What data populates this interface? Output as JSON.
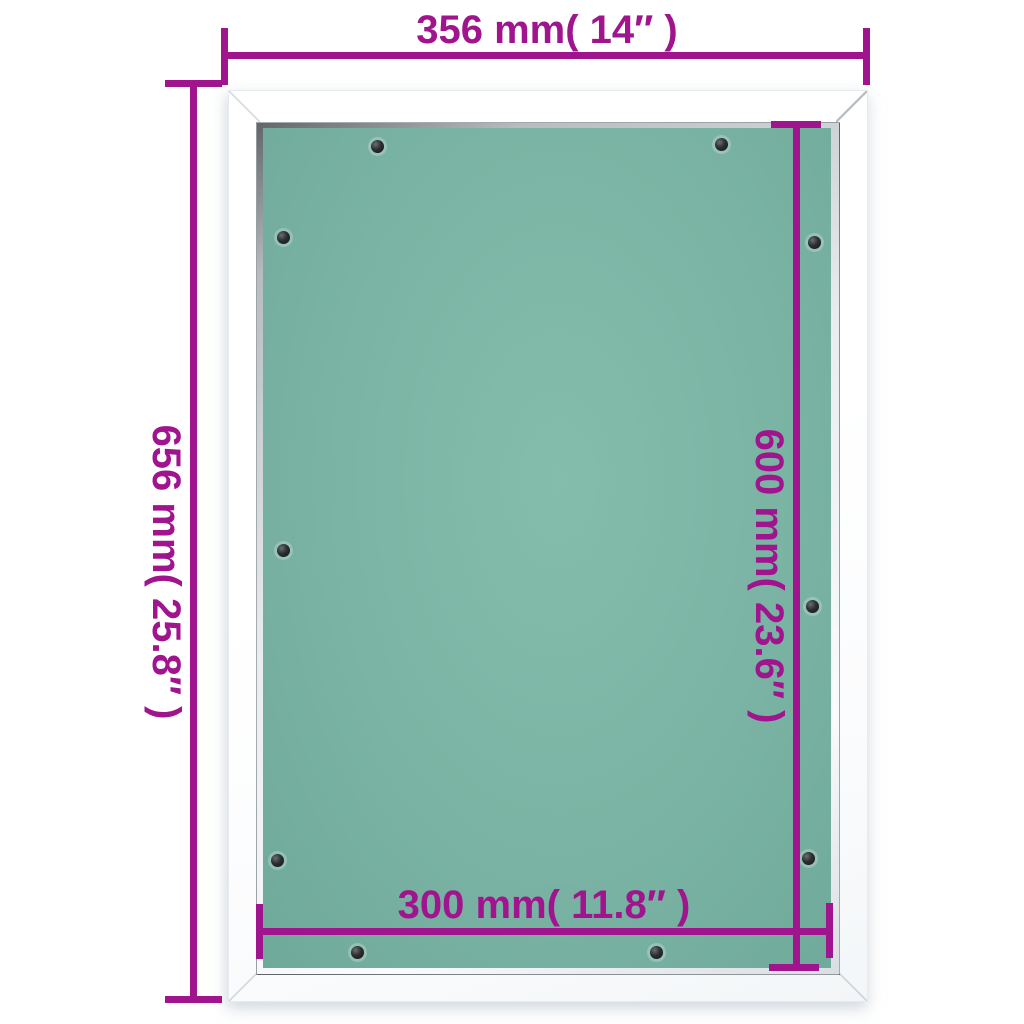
{
  "annotations": {
    "frame_width": "356 mm( 14″ )",
    "frame_height": "656 mm( 25.8″ )",
    "panel_height": "600 mm( 23.6″ )",
    "panel_width": "300 mm( 11.8″ )"
  },
  "colors": {
    "dimension_magenta": "#a0148e",
    "panel_green": "#7bb4a4",
    "panel_green_light": "#85bdac",
    "panel_green_dark": "#6fa99a",
    "frame_white": "#ffffff",
    "screw_black": "#141516"
  },
  "screws": [
    {
      "x": 377,
      "y": 146
    },
    {
      "x": 721,
      "y": 144
    },
    {
      "x": 283,
      "y": 237
    },
    {
      "x": 814,
      "y": 242
    },
    {
      "x": 283,
      "y": 550
    },
    {
      "x": 812,
      "y": 606
    },
    {
      "x": 277,
      "y": 860
    },
    {
      "x": 808,
      "y": 858
    },
    {
      "x": 357,
      "y": 952
    },
    {
      "x": 656,
      "y": 952
    }
  ]
}
